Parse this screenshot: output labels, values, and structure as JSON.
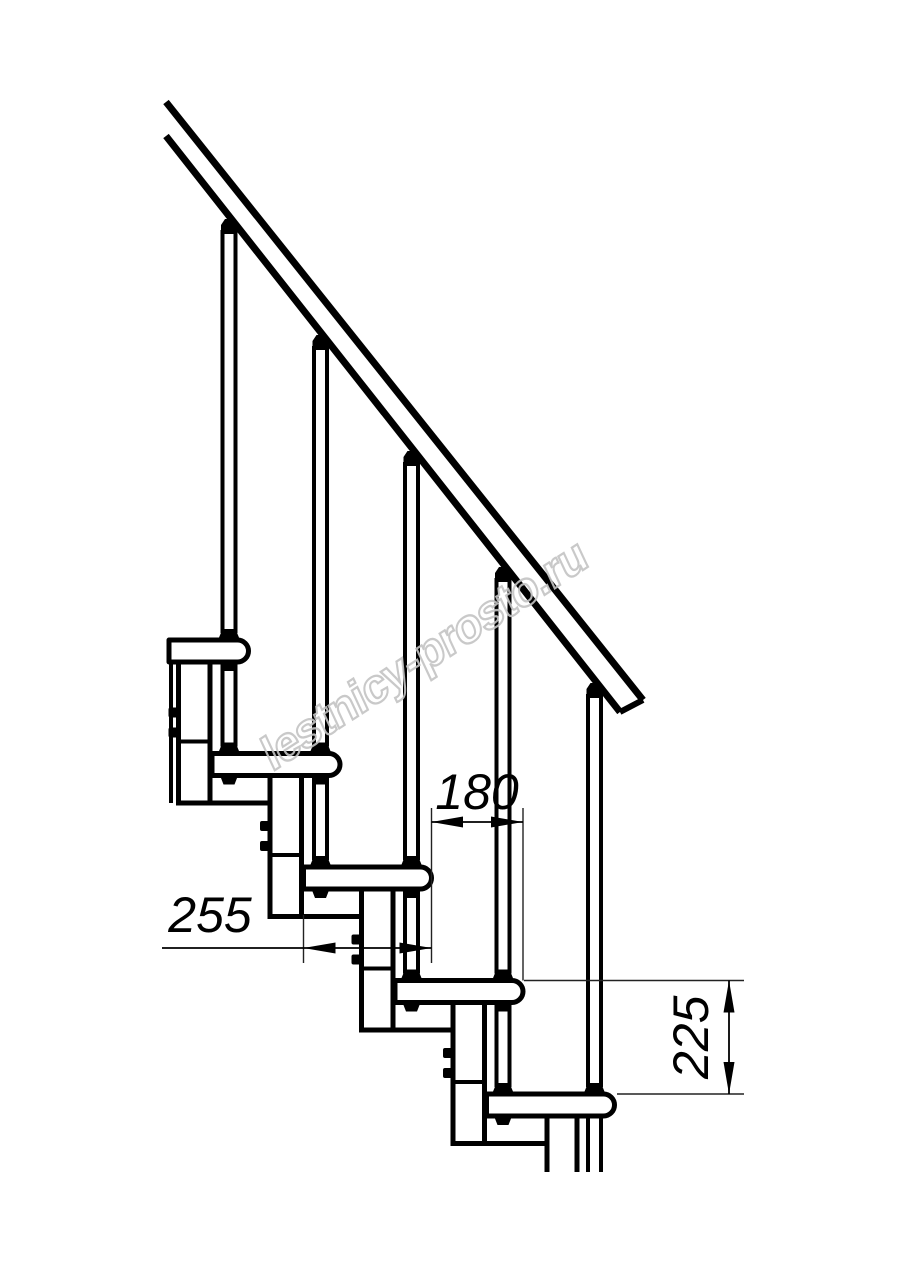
{
  "figure": {
    "kind": "modular staircase side-view technical drawing",
    "steps_count": 5
  },
  "watermark": {
    "text": "lestnicy-prosto.ru",
    "color": "#c4c4c4"
  },
  "dimensions": {
    "tread_depth": {
      "value": "255",
      "orientation": "horizontal"
    },
    "step_run": {
      "value": "180",
      "orientation": "horizontal"
    },
    "step_rise": {
      "value": "225",
      "orientation": "vertical"
    }
  },
  "colors": {
    "line": "#000000",
    "background": "#ffffff"
  }
}
